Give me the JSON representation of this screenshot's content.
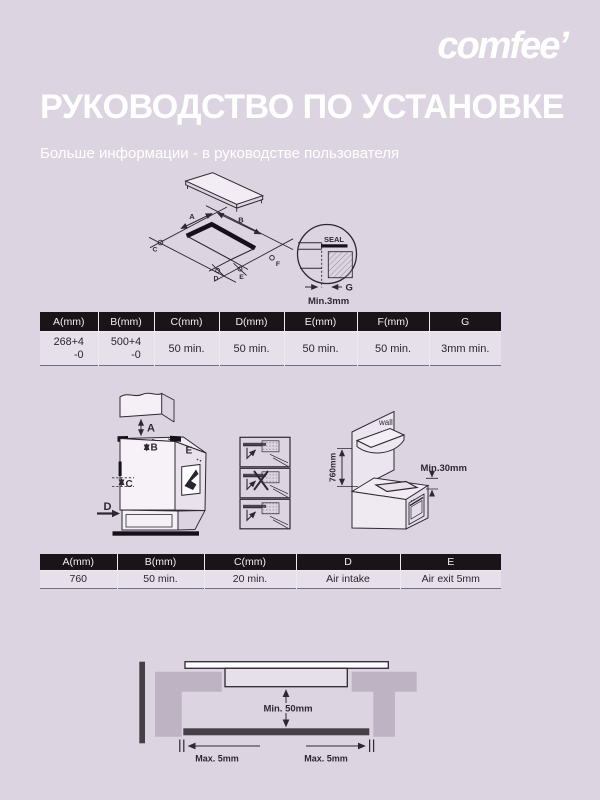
{
  "header": {
    "logo": "comfee’",
    "title": "РУКОВОДСТВО ПО УСТАНОВКЕ",
    "subtitle": "Больше информации - в руководстве пользователя"
  },
  "colors": {
    "background": "#DDD4E1",
    "header_text": "#FFFFFF",
    "table_header_bg": "#1A1317",
    "table_body_bg": "#E6E0EB",
    "diagram_line": "#2E2833",
    "counter_gray": "#BDB3C3",
    "bar_dark": "#453F47"
  },
  "cutout_diagram": {
    "label_a": "A",
    "label_b": "B",
    "label_c": "C",
    "label_d": "D",
    "label_e": "E",
    "label_f": "F",
    "seal_label": "SEAL",
    "gap_label": "G",
    "gap_note": "Min.3mm"
  },
  "table1": {
    "headers": [
      "A(mm)",
      "B(mm)",
      "C(mm)",
      "D(mm)",
      "E(mm)",
      "F(mm)",
      "G"
    ],
    "row": {
      "a_main": "268+4",
      "a_sub": "-0",
      "b_main": "500+4",
      "b_sub": "-0",
      "c": "50 min.",
      "d": "50 min.",
      "e": "50 min.",
      "f": "50 min.",
      "g": "3mm min."
    }
  },
  "clearance_diagram": {
    "label_a": "A",
    "label_b": "B",
    "label_c": "C",
    "label_d": "D",
    "label_e": "E",
    "wall_label": "wall",
    "wall_height": "760mm",
    "top_gap": "Min.30mm"
  },
  "table2": {
    "headers": [
      "A(mm)",
      "B(mm)",
      "C(mm)",
      "D",
      "E"
    ],
    "row": [
      "760",
      "50 min.",
      "20 min.",
      "Air intake",
      "Air exit 5mm"
    ]
  },
  "bottom_diagram": {
    "center_gap": "Min. 50mm",
    "left_gap": "Max. 5mm",
    "right_gap": "Max. 5mm"
  }
}
